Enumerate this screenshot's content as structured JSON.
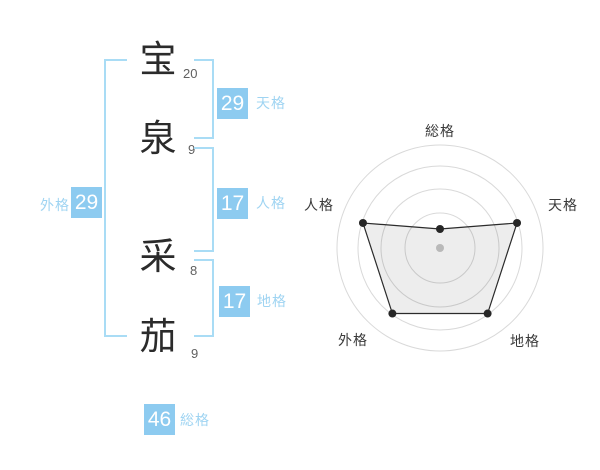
{
  "name_panel": {
    "characters": [
      {
        "char": "宝",
        "strokes": "20"
      },
      {
        "char": "泉",
        "strokes": "9"
      },
      {
        "char": "采",
        "strokes": "8"
      },
      {
        "char": "茄",
        "strokes": "9"
      }
    ],
    "results": {
      "tenkaku": {
        "value": "29",
        "label": "天格"
      },
      "jinkaku": {
        "value": "17",
        "label": "人格"
      },
      "chikaku": {
        "value": "17",
        "label": "地格"
      },
      "gaikaku": {
        "value": "29",
        "label": "外格"
      },
      "soukaku": {
        "value": "46",
        "label": "総格"
      }
    }
  },
  "colors": {
    "badge_bg": "#8dcbf0",
    "badge_text": "#ffffff",
    "result_label": "#9fd4f2",
    "bracket": "#a9dcf5",
    "kanji": "#2b2b2b",
    "stroke_count": "#606060"
  },
  "chart_data": {
    "type": "radar",
    "title": "",
    "axes": [
      "総格",
      "天格",
      "地格",
      "外格",
      "人格"
    ],
    "values": [
      1,
      4,
      4,
      4,
      4
    ],
    "max": 5,
    "grid_rings": 4,
    "legend": "none",
    "angles_deg": [
      -90,
      -18,
      54,
      126,
      198
    ],
    "point_radii_px": [
      19,
      81,
      81,
      81,
      81
    ],
    "ring_radii_px": [
      35,
      59,
      82,
      103
    ],
    "center_px": [
      140,
      138
    ],
    "label_pos_px": [
      [
        140,
        21
      ],
      [
        263,
        95
      ],
      [
        225,
        231
      ],
      [
        53,
        230
      ],
      [
        19,
        95
      ]
    ],
    "colors": {
      "ring": "#d9d9d9",
      "polygon_stroke": "#2b2b2b",
      "polygon_fill": "rgba(0,0,0,0.07)",
      "point": "#262626",
      "center_dot": "#c8c8c8",
      "axis_label": "#3a3a3a"
    }
  }
}
